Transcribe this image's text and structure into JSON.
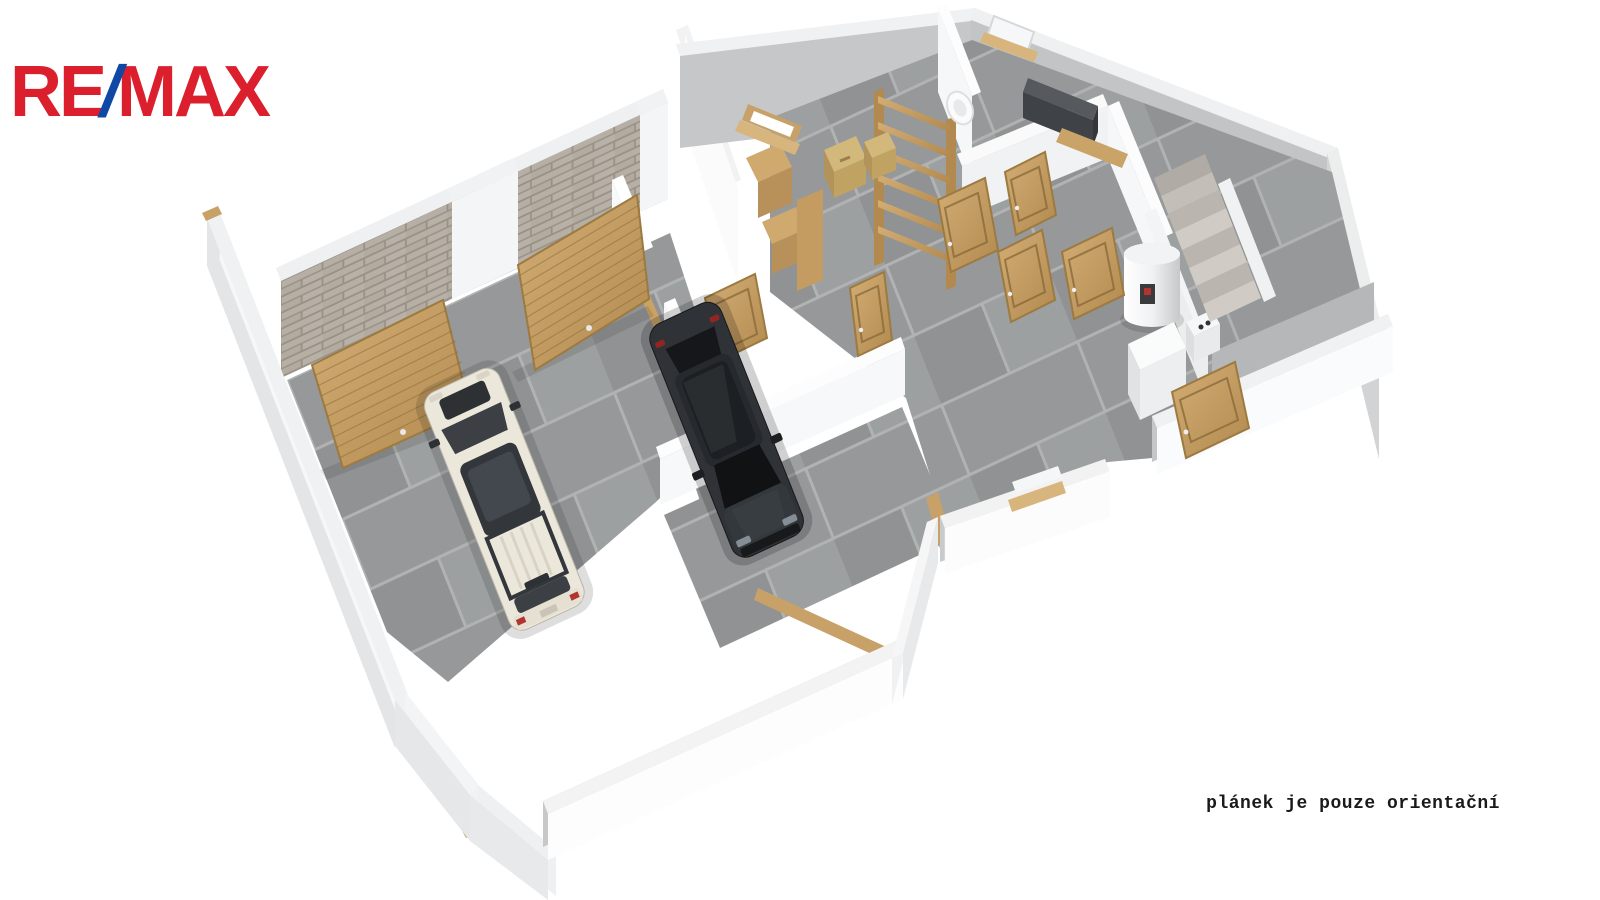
{
  "page": {
    "width": 1600,
    "height": 900,
    "background": "#ffffff",
    "kind": "real-estate 3D cutaway floor plan render"
  },
  "logo": {
    "re": "RE",
    "slash": "/",
    "max": "MAX",
    "color_red": "#DC1F2C",
    "color_blue": "#1049A5"
  },
  "disclaimer": {
    "text": "plánek je pouze orientační",
    "color": "#1a1a1a"
  },
  "scene": {
    "description": "isometric 3D cutaway plan of a garage level viewed from above",
    "rooms": [
      "garage",
      "corridor",
      "storage-room",
      "workshop-room",
      "hallway",
      "utility-room",
      "staircase",
      "south-room"
    ],
    "objects": [
      "white-suv",
      "black-suv",
      "garage-door-left",
      "garage-door-right",
      "brick-wall",
      "interior-doors",
      "wooden-shelf",
      "cardboard-boxes",
      "wooden-cabinets",
      "dark-wall-cabinet",
      "wash-basin",
      "water-heater",
      "boiler-unit",
      "stairs",
      "windows",
      "wood-baseboards"
    ],
    "colors": {
      "wall": "#f2f3f4",
      "wall_shadow": "#c6c7c9",
      "floor_tile": "#98999b",
      "brick": "#b4ada3",
      "wood": "#c8a168",
      "car_white": "#ece7db",
      "car_black": "#2f3337"
    }
  }
}
